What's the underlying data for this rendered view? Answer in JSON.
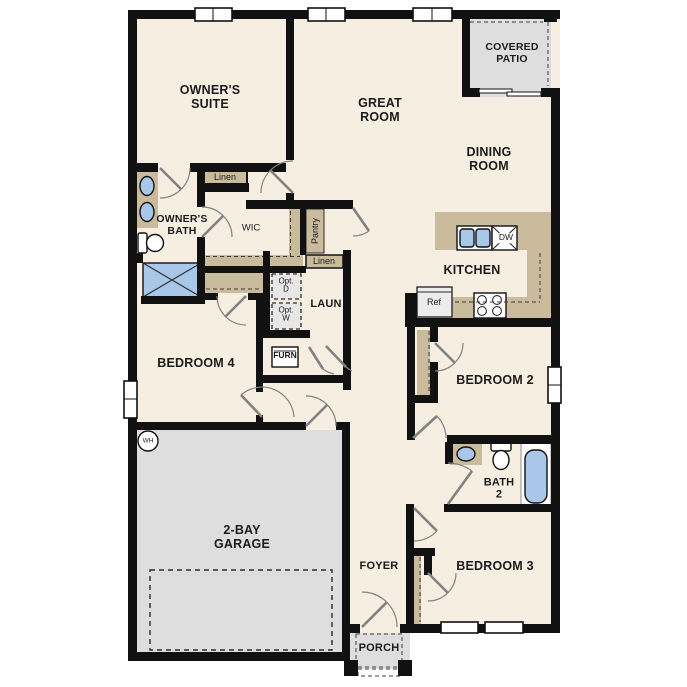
{
  "colors": {
    "floor": "#f6eee1",
    "wall": "#111111",
    "casework": "#cabb9d",
    "concrete": "#dedede",
    "blue": "#a9c8e9",
    "swing": "#828282",
    "label": "#1b1b1b"
  },
  "rooms": {
    "owners_suite": "OWNER'S SUITE",
    "great_room": "GREAT ROOM",
    "covered_patio": "COVERED PATIO",
    "dining_room": "DINING ROOM",
    "kitchen": "KITCHEN",
    "owners_bath": "OWNER'S BATH",
    "wic": "WIC",
    "laundry": "LAUN",
    "bedroom4": "BEDROOM 4",
    "garage": "2-BAY GARAGE",
    "bedroom2": "BEDROOM 2",
    "bath2": "BATH\n2",
    "bedroom3": "BEDROOM 3",
    "foyer": "FOYER",
    "porch": "PORCH"
  },
  "closets": {
    "linen_upper": "Linen",
    "linen_lower": "Linen",
    "pantry": "Pantry"
  },
  "appliances": {
    "refrigerator": "Ref",
    "dishwasher": "DW",
    "furnace": "FURN",
    "water_heater": "WH",
    "optional_dryer": "Opt.\nD",
    "optional_washer": "Opt.\nW"
  }
}
